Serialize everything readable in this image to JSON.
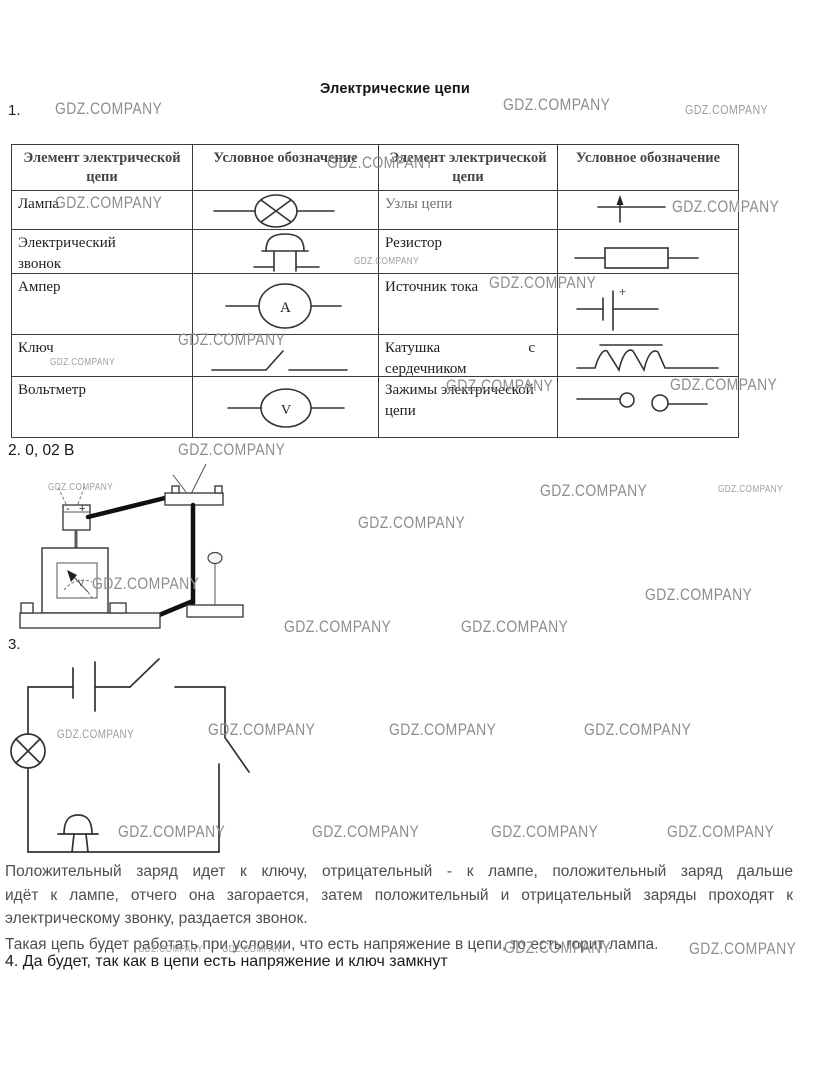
{
  "page": {
    "title": "Электрические цепи",
    "watermark_text": "GDZ.COMPANY"
  },
  "items": {
    "q1_number": "1.",
    "q2_number": "2.",
    "q2_answer": "0, 02 В",
    "q3_number": "3.",
    "q4_text": "4. Да будет, так как в цепи есть напряжение и ключ замкнут"
  },
  "table": {
    "headers": [
      "Элемент электрической цепи",
      "Условное обозначение",
      "Элемент электрической цепи",
      "Условное обозначение"
    ],
    "rows": [
      {
        "left_label": "Лампа",
        "left_symbol": "lamp",
        "right_label": "Узлы цепи",
        "right_symbol": "junction"
      },
      {
        "left_label": "Электрический звонок",
        "left_symbol": "bell",
        "right_label": "Резистор",
        "right_symbol": "resistor"
      },
      {
        "left_label": "Ампер",
        "left_symbol": "ammeter",
        "right_label": "Источник тока",
        "right_symbol": "current-source"
      },
      {
        "left_label": "Ключ",
        "left_symbol": "switch",
        "right_label": "Катушка с сердечником",
        "right_symbol": "coil-with-core"
      },
      {
        "left_label": "Вольтметр",
        "left_symbol": "voltmeter",
        "right_label": "Зажимы электрической цепи",
        "right_symbol": "terminals"
      }
    ],
    "symbols": {
      "ammeter_letter": "A",
      "voltmeter_letter": "V",
      "source_plus": "+"
    }
  },
  "diagram2": {
    "meter_letter": "V",
    "battery_minus": "-",
    "battery_plus": "+"
  },
  "answer_paragraph": {
    "lines": [
      "Положительный заряд идет к ключу, отрицательный - к лампе, положительный заряд дальше",
      "идёт к лампе, отчего она загорается, затем положительный и отрицательный заряды проходят к",
      "электрическому звонку, раздается звонок.",
      "Такая цепь будет работать при условии, что есть напряжение в цепи, то есть горит лампа."
    ]
  },
  "watermarks": [
    {
      "x": 55,
      "y": 100,
      "fs": 17
    },
    {
      "x": 503,
      "y": 96,
      "fs": 17
    },
    {
      "x": 685,
      "y": 103,
      "fs": 13
    },
    {
      "x": 327,
      "y": 154,
      "fs": 17
    },
    {
      "x": 55,
      "y": 194,
      "fs": 17
    },
    {
      "x": 672,
      "y": 198,
      "fs": 17
    },
    {
      "x": 354,
      "y": 257,
      "fs": 10
    },
    {
      "x": 489,
      "y": 274,
      "fs": 17
    },
    {
      "x": 178,
      "y": 331,
      "fs": 17
    },
    {
      "x": 50,
      "y": 358,
      "fs": 10
    },
    {
      "x": 446,
      "y": 377,
      "fs": 17
    },
    {
      "x": 670,
      "y": 376,
      "fs": 17
    },
    {
      "x": 178,
      "y": 441,
      "fs": 17
    },
    {
      "x": 48,
      "y": 483,
      "fs": 10
    },
    {
      "x": 540,
      "y": 482,
      "fs": 17
    },
    {
      "x": 718,
      "y": 485,
      "fs": 10
    },
    {
      "x": 358,
      "y": 514,
      "fs": 17
    },
    {
      "x": 92,
      "y": 575,
      "fs": 17
    },
    {
      "x": 645,
      "y": 586,
      "fs": 17
    },
    {
      "x": 284,
      "y": 618,
      "fs": 17
    },
    {
      "x": 461,
      "y": 618,
      "fs": 17
    },
    {
      "x": 57,
      "y": 728,
      "fs": 12
    },
    {
      "x": 208,
      "y": 721,
      "fs": 17
    },
    {
      "x": 389,
      "y": 721,
      "fs": 17
    },
    {
      "x": 584,
      "y": 721,
      "fs": 17
    },
    {
      "x": 118,
      "y": 823,
      "fs": 17
    },
    {
      "x": 312,
      "y": 823,
      "fs": 17
    },
    {
      "x": 491,
      "y": 823,
      "fs": 17
    },
    {
      "x": 667,
      "y": 823,
      "fs": 17
    },
    {
      "x": 138,
      "y": 945,
      "fs": 10
    },
    {
      "x": 222,
      "y": 945,
      "fs": 10
    },
    {
      "x": 504,
      "y": 939,
      "fs": 17
    },
    {
      "x": 689,
      "y": 940,
      "fs": 17
    }
  ]
}
